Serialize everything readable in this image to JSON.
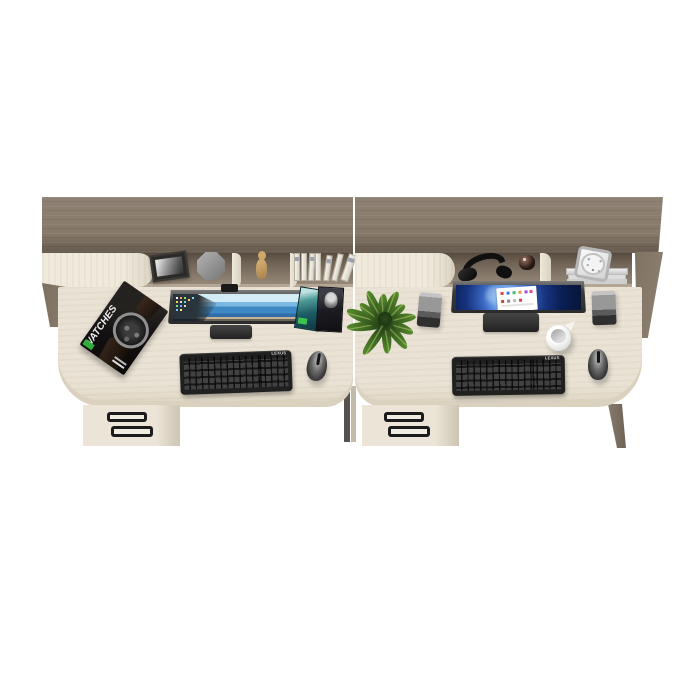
{
  "scene": {
    "type": "3d-render",
    "description": "Two matching office desks with hutch shelves viewed from above on a white background",
    "background": "#ffffff"
  },
  "palette": {
    "hutch_top_wood": "#86796b",
    "hutch_edge_wood": "#6a5e52",
    "shelf_interior": "#6e6255",
    "desk_surface": "#e8e1d3",
    "cream_panel": "#eee8da",
    "handle_black": "#1b1b1b",
    "device_black": "#222222",
    "left_screen_sea_blue": "#3e88c4",
    "right_screen_bloom_blue": "#2f5bb4",
    "plant_green": "#3f6a22",
    "speaker_grey": "#979797"
  },
  "left_desk": {
    "label": "left workstation",
    "shelf_items": [
      "photo frame",
      "grey pot",
      "tan figurine",
      "row of white books"
    ],
    "surface": {
      "magazine_title": "WATCHES",
      "monitor": "widescreen monitor, coastal beach wallpaper with desktop icons",
      "media_cases": "two leaning media cases",
      "keyboard_brand": "LEXUS",
      "mouse": "wireless mouse"
    },
    "drawer_handles": 2
  },
  "right_desk": {
    "label": "right workstation",
    "shelf_items": [
      "black headphones",
      "small dark jar",
      "desk clock on magazine stack"
    ],
    "surface": {
      "plant": "leafy green plant",
      "speakers": 2,
      "monitor": "widescreen monitor, blue bloom wallpaper with white document",
      "jug": "white jug",
      "keyboard_brand": "LEXUS",
      "mouse": "wireless mouse"
    },
    "drawer_handles": 2
  }
}
